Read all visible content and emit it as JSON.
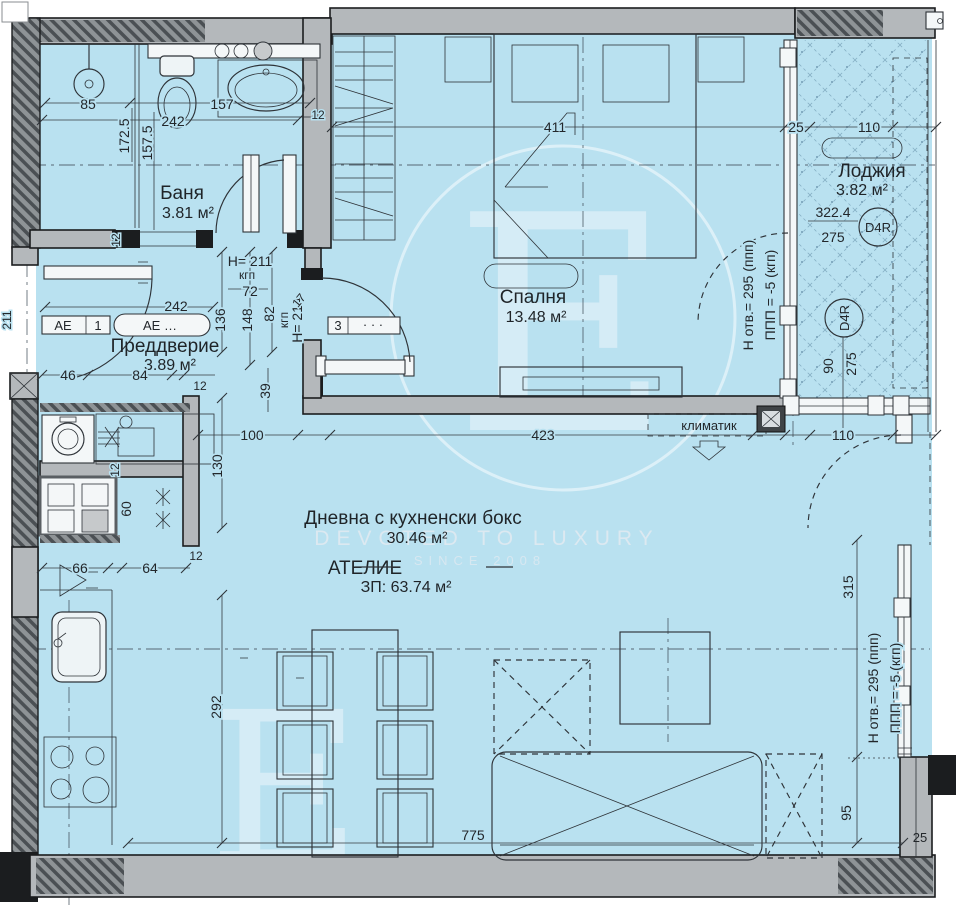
{
  "watermark": {
    "monogram": "E",
    "monogram2": "E",
    "line1": "DEVOTED TO LUXURY",
    "line2": "SINCE 2008"
  },
  "rooms": {
    "bathroom": {
      "name": "Баня",
      "area": "3.81 м²"
    },
    "hallway": {
      "name": "Преддверие",
      "area": "3.89 м²"
    },
    "bedroom": {
      "name": "Спалня",
      "area": "13.48 м²"
    },
    "loggia": {
      "name": "Лоджия",
      "area": "3.82 м²"
    },
    "living": {
      "name": "Дневна с кухненски бокс",
      "area": "30.46 м²"
    },
    "atelier": {
      "label": "АТЕЛИЕ",
      "total": "ЗП: 63.74 м²"
    }
  },
  "tags": {
    "ae_cell": "АЕ",
    "ae_num": "1",
    "ae_pill": "АЕ …",
    "door_num": "3",
    "door_dots": "· · ·",
    "ac_label": "климатик"
  },
  "notes": {
    "h211": "Н= 211",
    "kgp_a": "кгп",
    "dim72": "72",
    "h214": "H= 214",
    "kgp_b": "кгп",
    "n17": "17",
    "lvl211": "211",
    "win_a1": "Н отв.= 295 (ппп)",
    "win_a2": "ППП = -5 (кгп)",
    "win_b1": "Н отв.= 295 (ппп)",
    "win_b2": "ППП = -5 (кгп)",
    "d4r_1": "D4R",
    "d4r_2": "D4R"
  },
  "dims": {
    "bath_85": "85",
    "bath_157": "157",
    "bath_242": "242",
    "bath_1725": "172.5",
    "bath_1575": "157.5",
    "bath_12_right": "12",
    "bath_12_bottom": "12",
    "hall_242": "242",
    "hall_46": "46",
    "hall_84": "84",
    "hall_12": "12",
    "hall_136": "136",
    "hall_148": "148",
    "hall_82": "82",
    "hall_39": "39",
    "bed_411": "411",
    "mid_100": "100",
    "mid_423": "423",
    "mid_110": "110",
    "log_25": "25",
    "log_110": "110",
    "log_3224": "322.4",
    "log_275a": "275",
    "log_90": "90",
    "log_275b": "275",
    "kit_130": "130",
    "kit_12a": "12",
    "kit_60": "60",
    "kit_12b": "12",
    "kit_66": "66",
    "kit_64": "64",
    "kit_292": "292",
    "liv_775": "775",
    "liv_315": "315",
    "liv_95": "95",
    "liv_25": "25"
  },
  "colors": {
    "floor": "#b9e1f0",
    "wall": "#b4b8bb",
    "line": "#2e3338",
    "dark": "#1b1d1f"
  }
}
